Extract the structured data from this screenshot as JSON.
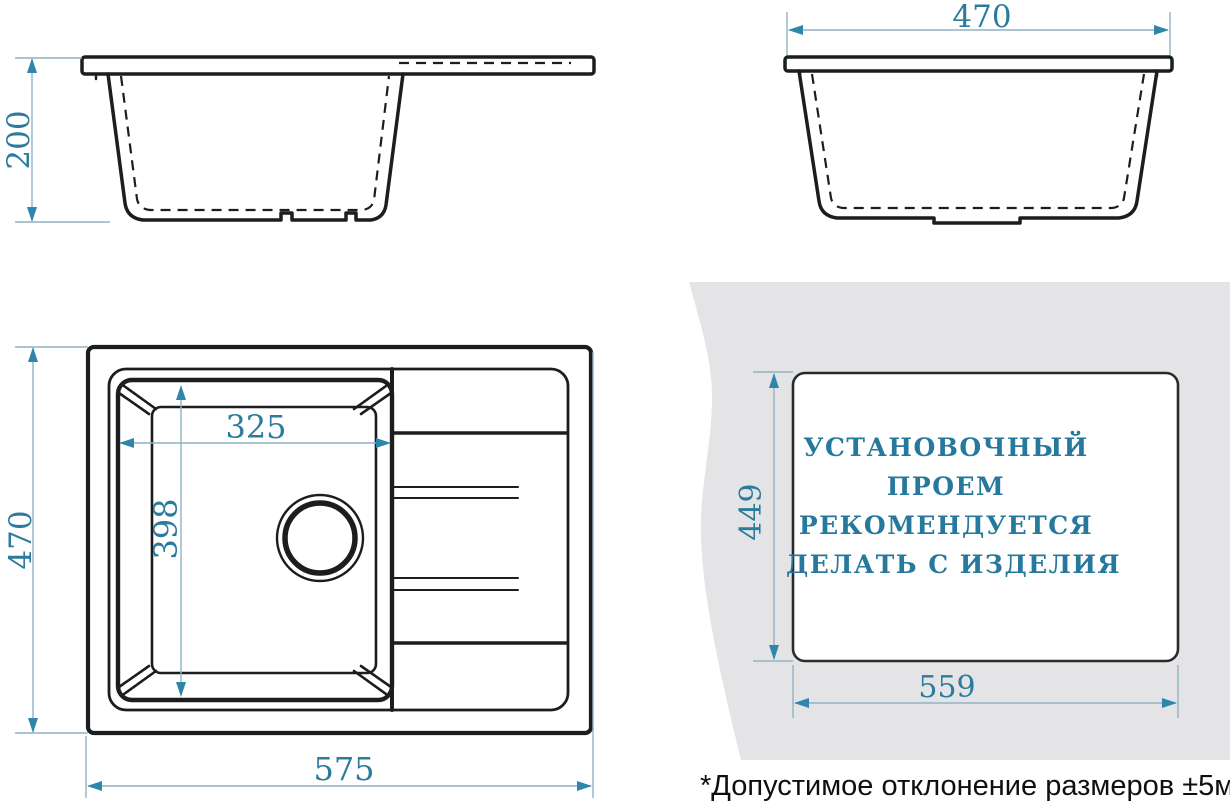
{
  "drawing": {
    "side_view": {
      "depth": "200"
    },
    "front_view": {
      "width": "470"
    },
    "plan_view": {
      "height": "470",
      "width": "575",
      "bowl_width": "325",
      "bowl_length": "398"
    },
    "cutout_view": {
      "height": "449",
      "width": "559",
      "note_line_1": "УСТАНОВОЧНЫЙ",
      "note_line_2": "ПРОЕМ",
      "note_line_3": "РЕКОМЕНДУЕТСЯ",
      "note_line_4": "ДЕЛАТЬ С ИЗДЕЛИЯ"
    },
    "footnote": "*Допустимое отклонение размеров ±5мм"
  },
  "colors": {
    "line": "#1d1d1f",
    "dimension_text": "#2a7b9c",
    "arrow": "#2e86ab",
    "extension_line": "#8fb3c4",
    "counter_gray": "#e4e4e6"
  }
}
